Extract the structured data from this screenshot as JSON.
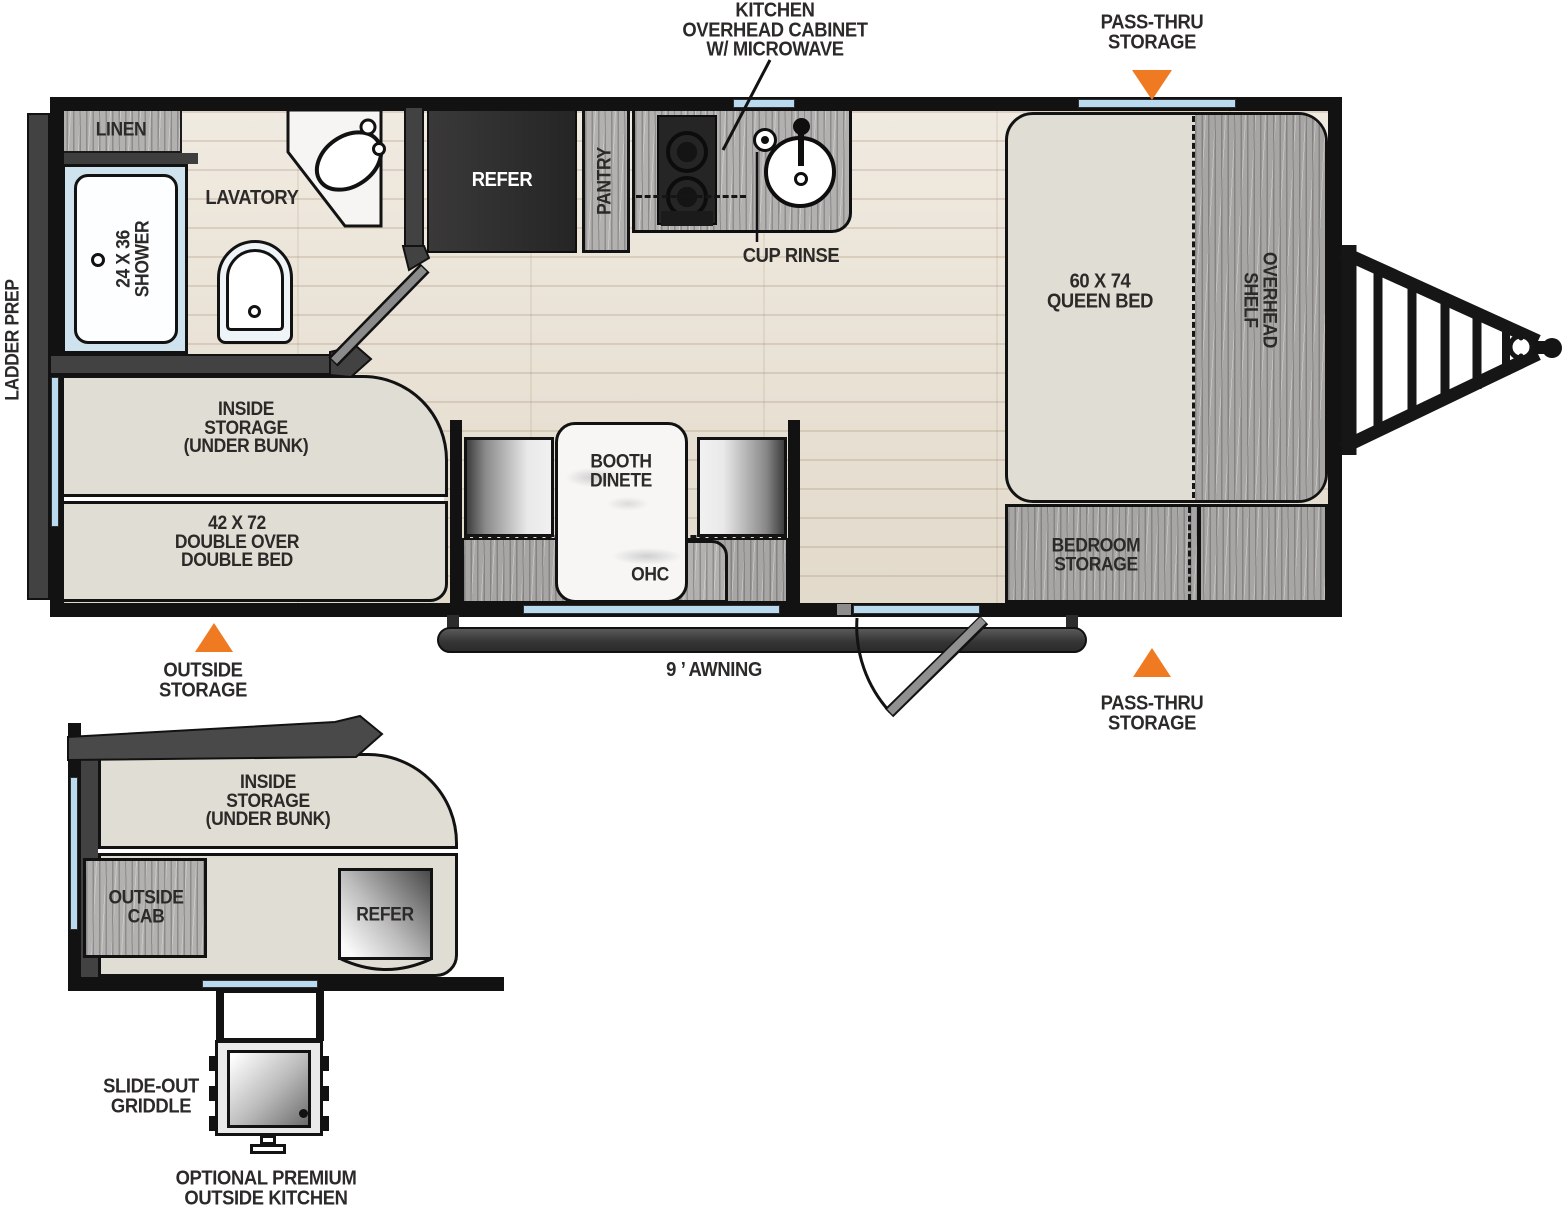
{
  "title": "Travel trailer floorplan diagram",
  "colors": {
    "accent_orange": "#f07a22",
    "window_blue": "#badbef",
    "wall_black": "#121212",
    "cabinet_wood_gray": "#b2b1af",
    "floor_wood": "#e9e1d3",
    "upholstery_beige": "#e0ddd4",
    "refrigerator_dark": "#2b2a2a"
  },
  "main_plan": {
    "exterior_labels": {
      "ladder_prep": "LADDER PREP",
      "kitchen_overhead_callout": "KITCHEN\nOVERHEAD CABINET\nW/ MICROWAVE",
      "pass_thru_storage_top": "PASS-THRU\nSTORAGE",
      "pass_thru_storage_bottom": "PASS-THRU\nSTORAGE",
      "outside_storage": "OUTSIDE\nSTORAGE",
      "awning": "9 ’ AWNING"
    },
    "rooms": {
      "linen": "LINEN",
      "lavatory": "LAVATORY",
      "shower": "24 X 36\nSHOWER",
      "refer": "REFER",
      "pantry": "PANTRY",
      "cup_rinse": "CUP RINSE",
      "queen_bed": "60 X 74\nQUEEN BED",
      "overhead_shelf": "OVERHEAD\nSHELF",
      "bedroom_storage": "BEDROOM\nSTORAGE",
      "booth_dinette": "BOOTH\nDINETE",
      "ohc": "OHC",
      "inside_storage": "INSIDE\nSTORAGE\n(UNDER BUNK)",
      "double_bed": "42 X 72\nDOUBLE OVER\nDOUBLE BED"
    }
  },
  "outside_kitchen_detail": {
    "inside_storage": "INSIDE\nSTORAGE\n(UNDER BUNK)",
    "outside_cab": "OUTSIDE\nCAB",
    "refer": "REFER",
    "slide_out_griddle": "SLIDE-OUT\nGRIDDLE",
    "caption": "OPTIONAL PREMIUM\nOUTSIDE KITCHEN"
  }
}
